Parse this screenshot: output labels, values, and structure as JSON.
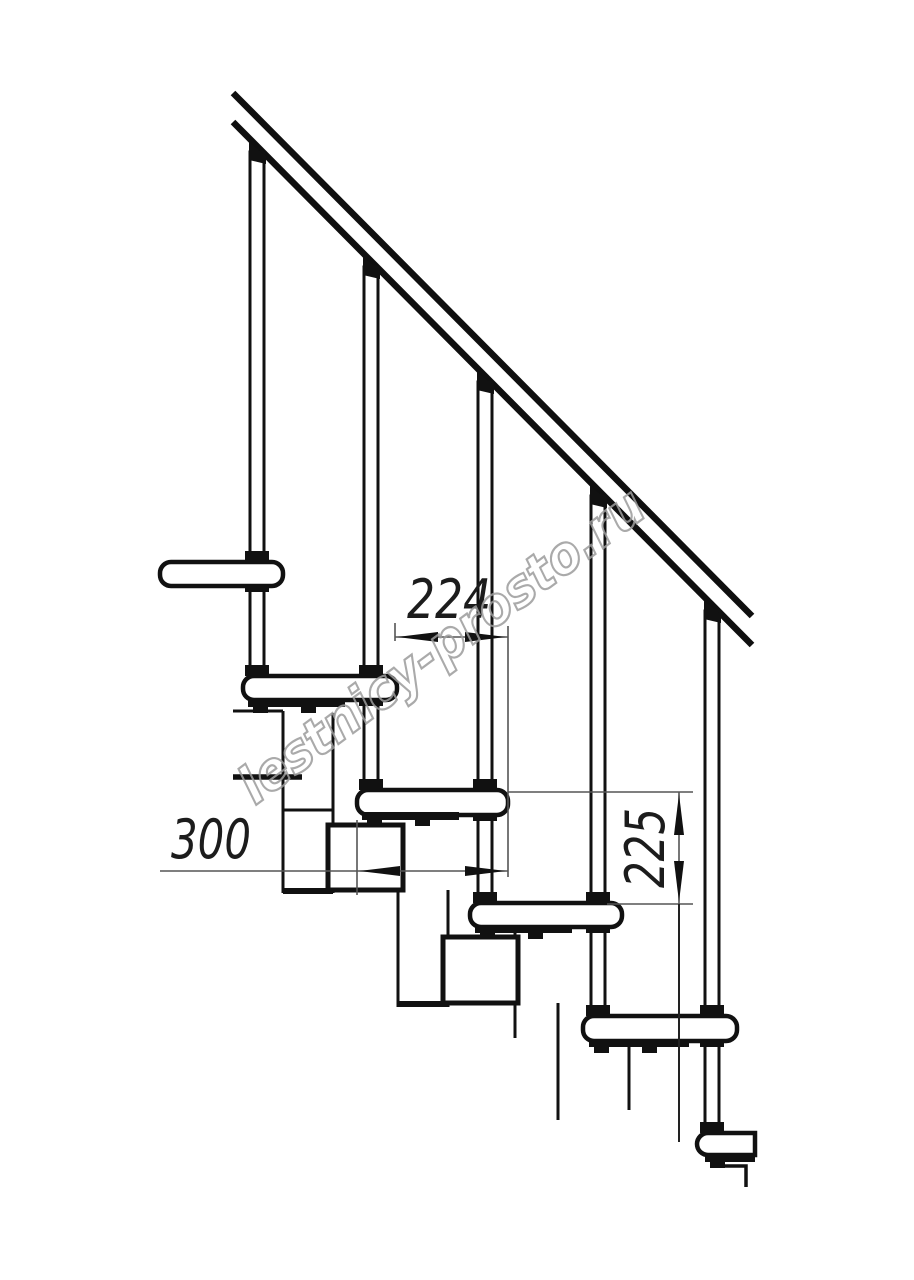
{
  "page": {
    "background": "#ffffff",
    "description": "Black-and-white technical side-elevation drawing of a modular staircase with handrail, balusters, treads and support modules"
  },
  "watermark": {
    "text": "lestnicy-prosto.ru",
    "color": "#9c9c9c"
  },
  "dimensions": {
    "step_run": {
      "value": "224",
      "orientation": "horizontal"
    },
    "tread_depth": {
      "value": "300",
      "orientation": "horizontal"
    },
    "step_rise": {
      "value": "225",
      "orientation": "vertical"
    }
  },
  "structure": {
    "handrail": "diagonal double line, top-left to mid-right",
    "balusters": 5,
    "treads": 6,
    "support_modules": "zig-zag stacked boxes under treads",
    "line_color": "#111111",
    "thin_line_color": "#555555"
  }
}
